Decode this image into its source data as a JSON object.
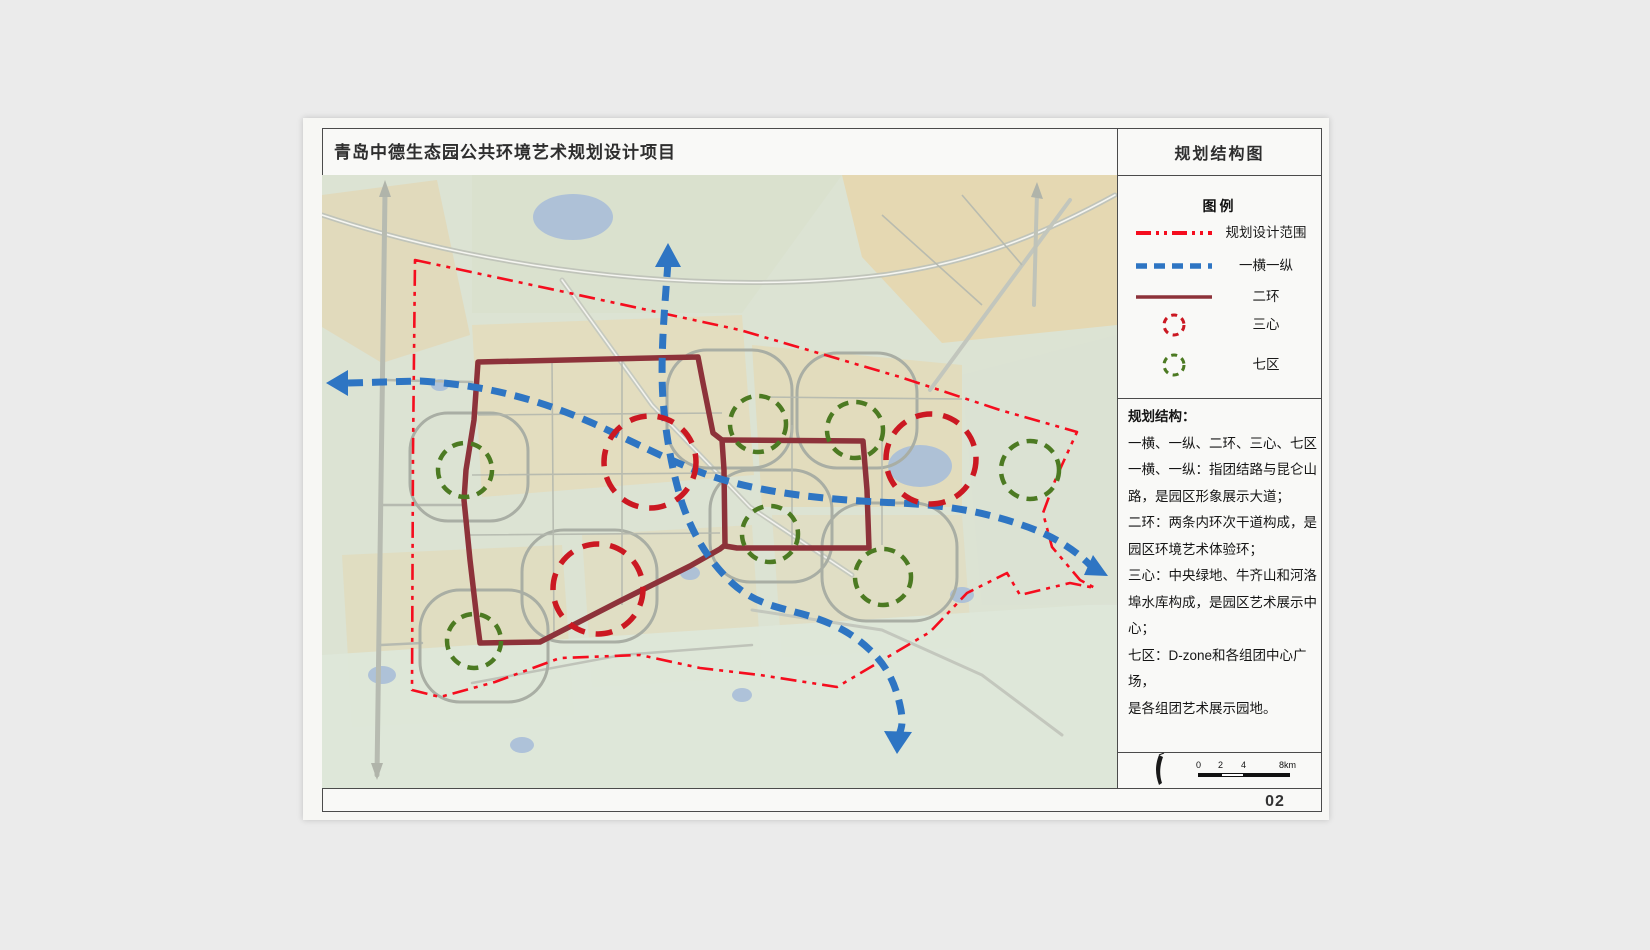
{
  "header": {
    "project_title": "青岛中德生态园公共环境艺术规划设计项目",
    "sheet_title": "规划结构图"
  },
  "legend": {
    "title": "图例",
    "items": [
      {
        "label": "规划设计范围",
        "symbol": "red-dashdot-line"
      },
      {
        "label": "一横一纵",
        "symbol": "blue-dashed-line"
      },
      {
        "label": "二环",
        "symbol": "maroon-solid-line"
      },
      {
        "label": "三心",
        "symbol": "red-dashed-circle"
      },
      {
        "label": "七区",
        "symbol": "green-dashed-circle"
      }
    ]
  },
  "structure": {
    "heading": "规划结构：",
    "body": "一横、一纵、二环、三心、七区\n一横、一纵：指团结路与昆仑山\n路，是园区形象展示大道；\n二环：两条内环次干道构成，是\n园区环境艺术体验环；\n三心：中央绿地、牛齐山和河洛\n埠水库构成，是园区艺术展示中\n心；\n七区：D-zone和各组团中心广场，\n是各组团艺术展示园地。"
  },
  "map": {
    "boundary_label": "规划设计范围",
    "routes_label": "一横一纵",
    "ring_label": "二环",
    "centers_label": "三心",
    "centers_count": 3,
    "zones_label": "七区",
    "zones_count": 7
  },
  "scalebar": {
    "labels": [
      "0",
      "2",
      "4",
      "8km"
    ]
  },
  "footer": {
    "page_number": "02"
  },
  "colors": {
    "canvas": "#ebebeb",
    "sheet": "#f7f7f4",
    "frame": "#4b4b4b",
    "map_background": "#dce3d3",
    "land_tan": "#e5d9b4",
    "water": "#a9bed8",
    "road_grey": "#b3b8ae",
    "boundary_red": "#f50d1e",
    "route_blue": "#2e75c3",
    "ring_maroon": "#8d323a",
    "center_red": "#cb1822",
    "zone_green": "#4c7a22"
  }
}
